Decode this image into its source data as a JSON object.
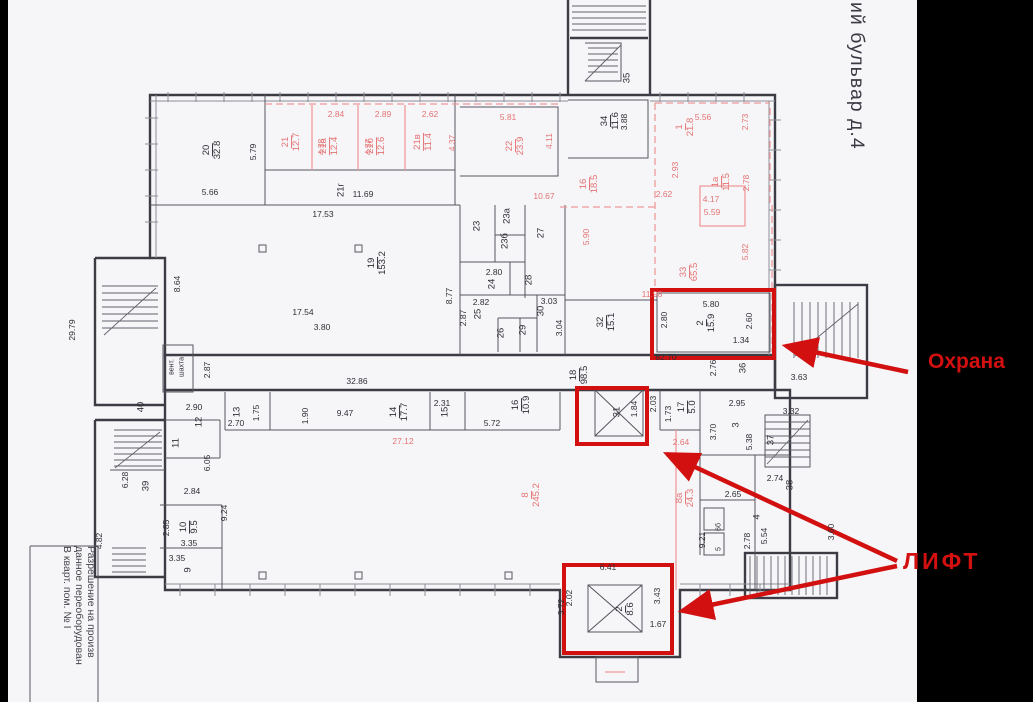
{
  "page": {
    "background": "#000000",
    "paper": "#f6f6f9"
  },
  "street_sign": {
    "text": "ий бульвар д.4"
  },
  "annotations": {
    "color": "#d21010",
    "security_label": "Охрана",
    "elevator_label": "ЛИФТ"
  },
  "title_block": {
    "lines": [
      "Разрешение на произв",
      "данное переоборудован",
      "В кварт. пом. № I"
    ]
  },
  "plan": {
    "ink": "#3c3c44",
    "pink": "#ef9a9a",
    "pink_text": "#e57373",
    "rooms": [
      {
        "n": "20",
        "a": "32.8",
        "x": 213,
        "y": 150,
        "r": -90
      },
      {
        "n": "21",
        "a": "12.7",
        "x": 292,
        "y": 142,
        "r": -90,
        "c": "p"
      },
      {
        "n": "21а",
        "a": "12.4",
        "x": 330,
        "y": 146,
        "r": -90,
        "c": "p"
      },
      {
        "n": "21б",
        "a": "12.6",
        "x": 377,
        "y": 146,
        "r": -90,
        "c": "p"
      },
      {
        "n": "21в",
        "a": "11.4",
        "x": 424,
        "y": 142,
        "r": -90,
        "c": "p"
      },
      {
        "n": "22",
        "a": "23.9",
        "x": 516,
        "y": 146,
        "r": -90,
        "c": "p"
      },
      {
        "n": "34",
        "a": "11.6",
        "x": 611,
        "y": 121,
        "r": -90
      },
      {
        "n": "1",
        "a": "21.8",
        "x": 686,
        "y": 127,
        "r": -90,
        "c": "p"
      },
      {
        "n": "1а",
        "a": "11.5",
        "x": 722,
        "y": 182,
        "r": -90,
        "c": "p"
      },
      {
        "n": "16",
        "a": "18.5",
        "x": 590,
        "y": 184,
        "r": -90,
        "c": "p"
      },
      {
        "n": "33",
        "a": "65.5",
        "x": 690,
        "y": 272,
        "r": -90,
        "c": "p"
      },
      {
        "n": "19",
        "a": "153.2",
        "x": 378,
        "y": 263,
        "r": -90
      },
      {
        "n": "2",
        "a": "15.9",
        "x": 707,
        "y": 323,
        "r": -90
      },
      {
        "n": "32",
        "a": "15.1",
        "x": 607,
        "y": 322,
        "r": -90
      },
      {
        "n": "18",
        "a": "98.5",
        "x": 580,
        "y": 375,
        "r": -90
      },
      {
        "n": "17",
        "a": "5.0",
        "x": 688,
        "y": 407,
        "r": -90
      },
      {
        "n": "14",
        "a": "17.7",
        "x": 400,
        "y": 412,
        "r": -90
      },
      {
        "n": "16",
        "a": "10.9",
        "x": 522,
        "y": 405,
        "r": -90
      },
      {
        "n": "8",
        "a": "245.2",
        "x": 532,
        "y": 495,
        "r": -90,
        "c": "p"
      },
      {
        "n": "8а",
        "a": "24.3",
        "x": 686,
        "y": 498,
        "r": -90,
        "c": "p"
      },
      {
        "n": "10",
        "a": "9.5",
        "x": 190,
        "y": 527,
        "r": -90
      },
      {
        "n": "2",
        "a": "8.6",
        "x": 626,
        "y": 609,
        "r": -90
      }
    ],
    "nums": [
      {
        "t": "35",
        "x": 627,
        "y": 78,
        "r": -90
      },
      {
        "t": "21г",
        "x": 341,
        "y": 190,
        "r": -90
      },
      {
        "t": "23",
        "x": 477,
        "y": 226,
        "r": -90
      },
      {
        "t": "23а",
        "x": 507,
        "y": 216,
        "r": -90
      },
      {
        "t": "23б",
        "x": 505,
        "y": 241,
        "r": -90
      },
      {
        "t": "27",
        "x": 541,
        "y": 233,
        "r": -90
      },
      {
        "t": "24",
        "x": 492,
        "y": 284,
        "r": -90
      },
      {
        "t": "28",
        "x": 529,
        "y": 280,
        "r": -90
      },
      {
        "t": "25",
        "x": 478,
        "y": 314,
        "r": -90
      },
      {
        "t": "30",
        "x": 541,
        "y": 311,
        "r": -90
      },
      {
        "t": "26",
        "x": 501,
        "y": 333,
        "r": -90
      },
      {
        "t": "29",
        "x": 523,
        "y": 330,
        "r": -90
      },
      {
        "t": "31",
        "x": 617,
        "y": 412,
        "r": -90
      },
      {
        "t": "36",
        "x": 743,
        "y": 368,
        "r": -90
      },
      {
        "t": "3",
        "x": 736,
        "y": 425,
        "r": -90
      },
      {
        "t": "37",
        "x": 771,
        "y": 440,
        "r": -90
      },
      {
        "t": "38",
        "x": 790,
        "y": 485,
        "r": -90
      },
      {
        "t": "4",
        "x": 757,
        "y": 517,
        "r": -90
      },
      {
        "t": "6б",
        "x": 719,
        "y": 527,
        "r": -90,
        "s": 7
      },
      {
        "t": "5",
        "x": 719,
        "y": 549,
        "r": -90,
        "s": 7
      },
      {
        "t": "40",
        "x": 141,
        "y": 407,
        "r": -90
      },
      {
        "t": "12",
        "x": 199,
        "y": 422,
        "r": -90
      },
      {
        "t": "13",
        "x": 237,
        "y": 412,
        "r": -90
      },
      {
        "t": "11",
        "x": 176,
        "y": 443,
        "r": -90
      },
      {
        "t": "39",
        "x": 146,
        "y": 486,
        "r": -90
      },
      {
        "t": "9",
        "x": 188,
        "y": 570,
        "r": -90
      },
      {
        "t": "15",
        "x": 445,
        "y": 412,
        "r": -90
      }
    ],
    "dims": [
      {
        "t": "5.79",
        "x": 253,
        "y": 152,
        "r": -90
      },
      {
        "t": "5.66",
        "x": 210,
        "y": 192,
        "r": 0
      },
      {
        "t": "2.84",
        "x": 336,
        "y": 114,
        "r": 0,
        "c": "p"
      },
      {
        "t": "4.38",
        "x": 321,
        "y": 147,
        "r": -90,
        "c": "p"
      },
      {
        "t": "2.89",
        "x": 383,
        "y": 114,
        "r": 0,
        "c": "p"
      },
      {
        "t": "4.37",
        "x": 368,
        "y": 147,
        "r": -90,
        "c": "p"
      },
      {
        "t": "2.62",
        "x": 430,
        "y": 114,
        "r": 0,
        "c": "p"
      },
      {
        "t": "4.37",
        "x": 452,
        "y": 143,
        "r": -90,
        "c": "p"
      },
      {
        "t": "11.69",
        "x": 363,
        "y": 194,
        "r": 0
      },
      {
        "t": "17.53",
        "x": 323,
        "y": 214,
        "r": 0
      },
      {
        "t": "5.81",
        "x": 508,
        "y": 117,
        "r": 0,
        "c": "p"
      },
      {
        "t": "4.11",
        "x": 549,
        "y": 141,
        "r": -90,
        "c": "p"
      },
      {
        "t": "3.88",
        "x": 624,
        "y": 122,
        "r": -90
      },
      {
        "t": "5.56",
        "x": 703,
        "y": 117,
        "r": 0,
        "c": "p"
      },
      {
        "t": "2.73",
        "x": 745,
        "y": 122,
        "r": -90,
        "c": "p"
      },
      {
        "t": "2.93",
        "x": 675,
        "y": 170,
        "r": -90,
        "c": "p"
      },
      {
        "t": "2.78",
        "x": 746,
        "y": 183,
        "r": -90,
        "c": "p"
      },
      {
        "t": "4.17",
        "x": 711,
        "y": 199,
        "r": 0,
        "c": "p"
      },
      {
        "t": "2.62",
        "x": 664,
        "y": 194,
        "r": 0,
        "c": "p"
      },
      {
        "t": "10.67",
        "x": 544,
        "y": 196,
        "r": 0,
        "c": "p"
      },
      {
        "t": "5.90",
        "x": 586,
        "y": 237,
        "r": -90,
        "c": "p"
      },
      {
        "t": "5.59",
        "x": 712,
        "y": 212,
        "r": 0,
        "c": "p"
      },
      {
        "t": "5.82",
        "x": 745,
        "y": 252,
        "r": -90,
        "c": "p"
      },
      {
        "t": "11.98",
        "x": 652,
        "y": 294,
        "r": 0,
        "c": "p"
      },
      {
        "t": "5.80",
        "x": 711,
        "y": 304,
        "r": 0
      },
      {
        "t": "2.80",
        "x": 664,
        "y": 320,
        "r": -90
      },
      {
        "t": "2.60",
        "x": 749,
        "y": 321,
        "r": -90
      },
      {
        "t": "1.34",
        "x": 741,
        "y": 340,
        "r": 0
      },
      {
        "t": "82.70",
        "x": 666,
        "y": 357,
        "r": 0
      },
      {
        "t": "2.76",
        "x": 713,
        "y": 368,
        "r": -90
      },
      {
        "t": "3.63",
        "x": 799,
        "y": 377,
        "r": 0
      },
      {
        "t": "8.64",
        "x": 177,
        "y": 284,
        "r": -90
      },
      {
        "t": "8.77",
        "x": 449,
        "y": 296,
        "r": -90
      },
      {
        "t": "17.54",
        "x": 303,
        "y": 312,
        "r": 0
      },
      {
        "t": "3.80",
        "x": 322,
        "y": 327,
        "r": 0
      },
      {
        "t": "2.87",
        "x": 463,
        "y": 318,
        "r": -90
      },
      {
        "t": "2.80",
        "x": 494,
        "y": 272,
        "r": 0
      },
      {
        "t": "2.82",
        "x": 481,
        "y": 302,
        "r": 0
      },
      {
        "t": "3.03",
        "x": 549,
        "y": 301,
        "r": 0
      },
      {
        "t": "3.04",
        "x": 559,
        "y": 328,
        "r": -90
      },
      {
        "t": "32.86",
        "x": 357,
        "y": 381,
        "r": 0
      },
      {
        "t": "1.84",
        "x": 634,
        "y": 409,
        "r": -90
      },
      {
        "t": "2.03",
        "x": 653,
        "y": 404,
        "r": -90
      },
      {
        "t": "1.73",
        "x": 668,
        "y": 414,
        "r": -90
      },
      {
        "t": "2.95",
        "x": 737,
        "y": 403,
        "r": 0
      },
      {
        "t": "3.70",
        "x": 713,
        "y": 432,
        "r": -90
      },
      {
        "t": "5.38",
        "x": 749,
        "y": 442,
        "r": -90
      },
      {
        "t": "3.32",
        "x": 791,
        "y": 411,
        "r": 0
      },
      {
        "t": "2.74",
        "x": 775,
        "y": 478,
        "r": 0
      },
      {
        "t": "2.65",
        "x": 733,
        "y": 494,
        "r": 0
      },
      {
        "t": "5.54",
        "x": 764,
        "y": 536,
        "r": -90
      },
      {
        "t": "2.78",
        "x": 747,
        "y": 541,
        "r": -90
      },
      {
        "t": "9.21",
        "x": 702,
        "y": 540,
        "r": -90
      },
      {
        "t": "2.64",
        "x": 681,
        "y": 442,
        "r": 0,
        "c": "p"
      },
      {
        "t": "27.12",
        "x": 403,
        "y": 441,
        "r": 0,
        "c": "p"
      },
      {
        "t": "2.90",
        "x": 194,
        "y": 407,
        "r": 0
      },
      {
        "t": "2.70",
        "x": 236,
        "y": 423,
        "r": 0
      },
      {
        "t": "1.75",
        "x": 256,
        "y": 413,
        "r": -90
      },
      {
        "t": "2.87",
        "x": 207,
        "y": 370,
        "r": -90
      },
      {
        "t": "6.05",
        "x": 207,
        "y": 463,
        "r": -90
      },
      {
        "t": "6.28",
        "x": 125,
        "y": 480,
        "r": -90
      },
      {
        "t": "2.84",
        "x": 192,
        "y": 491,
        "r": 0
      },
      {
        "t": "9.24",
        "x": 224,
        "y": 513,
        "r": -90
      },
      {
        "t": "2.85",
        "x": 166,
        "y": 528,
        "r": -90
      },
      {
        "t": "3.35",
        "x": 189,
        "y": 543,
        "r": 0
      },
      {
        "t": "3.35",
        "x": 177,
        "y": 558,
        "r": 0
      },
      {
        "t": "4.82",
        "x": 99,
        "y": 541,
        "r": -90
      },
      {
        "t": "29.79",
        "x": 72,
        "y": 330,
        "r": -90
      },
      {
        "t": "1.90",
        "x": 305,
        "y": 416,
        "r": -90
      },
      {
        "t": "9.47",
        "x": 345,
        "y": 413,
        "r": 0
      },
      {
        "t": "2.31",
        "x": 442,
        "y": 403,
        "r": 0
      },
      {
        "t": "5.72",
        "x": 492,
        "y": 423,
        "r": 0
      },
      {
        "t": "6.41",
        "x": 608,
        "y": 567,
        "r": 0
      },
      {
        "t": "2.02",
        "x": 569,
        "y": 598,
        "r": -90
      },
      {
        "t": "3.72",
        "x": 561,
        "y": 607,
        "r": -90
      },
      {
        "t": "3.43",
        "x": 657,
        "y": 596,
        "r": -90
      },
      {
        "t": "1.67",
        "x": 658,
        "y": 624,
        "r": 0
      },
      {
        "t": "3.60",
        "x": 831,
        "y": 532,
        "r": -90
      },
      {
        "t": "вент.",
        "x": 172,
        "y": 367,
        "r": -90,
        "s": 7
      },
      {
        "t": "шахта",
        "x": 182,
        "y": 367,
        "r": -90,
        "s": 7
      }
    ]
  }
}
